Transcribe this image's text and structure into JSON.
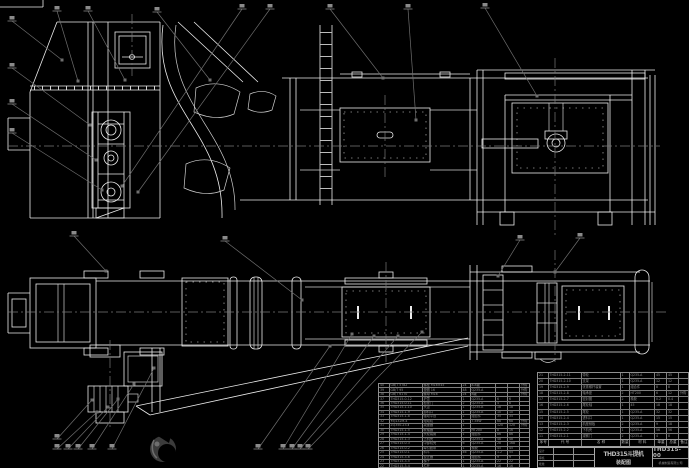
{
  "drawing": {
    "title": "THD315斗提机",
    "subtitle": "装配图",
    "drawing_no": "THD315-00",
    "company": "机械制造有限公司"
  },
  "colors": {
    "background": "#000000",
    "linework": "#ececec",
    "dim_gray": "#8a8a8a",
    "leader_gray": "#6e6e6e",
    "logo_gray": "#3b3b3b"
  },
  "title_block": {
    "signature_rows": [
      "设计",
      "审核",
      "批准"
    ]
  },
  "bom_header": [
    "序号",
    "代 号",
    "名 称",
    "数量",
    "材 料",
    "单重",
    "总重",
    "备注"
  ],
  "bom_left": {
    "rows": [
      [
        "40",
        "GB/T 5782",
        "螺栓 M16×45",
        "24",
        "8.8级",
        "",
        "",
        "外购"
      ],
      [
        "39",
        "GB/T 95",
        "垫圈 16",
        "48",
        "Q235-A",
        "",
        "",
        "外购"
      ],
      [
        "38",
        "GB/T 6170",
        "螺母 M16",
        "24",
        "8级",
        "",
        "",
        "外购"
      ],
      [
        "37",
        "THD315-0-12",
        "护罩",
        "1",
        "Q235-A",
        "6",
        "6",
        ""
      ],
      [
        "36",
        "THD315-0-11",
        "检视门",
        "2",
        "Q235-A",
        "4",
        "8",
        ""
      ],
      [
        "35",
        "THD315-1-10",
        "头罩",
        "1",
        "Q235-A",
        "18",
        "18",
        ""
      ],
      [
        "34",
        "THD315-1-9",
        "卸料口",
        "1",
        "Q235-A",
        "10",
        "10",
        ""
      ],
      [
        "33",
        "THD315-1-8",
        "驱动平台",
        "1",
        "组合件",
        "35",
        "35",
        ""
      ],
      [
        "32",
        "YEJ132M-4",
        "电动机",
        "1",
        "7.5kW",
        "68",
        "68",
        "外购"
      ],
      [
        "31",
        "ZQ350-23-Ⅱ",
        "减速器",
        "1",
        "",
        "120",
        "120",
        "外购"
      ],
      [
        "30",
        "THD315-1-5",
        "联轴器",
        "2",
        "HT200",
        "8",
        "16",
        ""
      ],
      [
        "29",
        "THD315-1-4",
        "头轮装置",
        "1",
        "组合件",
        "86",
        "86",
        ""
      ],
      [
        "28",
        "THD315-1-3",
        "上机壳",
        "1",
        "Q235-A",
        "48",
        "48",
        ""
      ],
      [
        "27",
        "THD315-0-3",
        "中部机壳",
        "6",
        "Q235-A",
        "28",
        "168",
        ""
      ],
      [
        "26",
        "THD315-0-2",
        "牵引胶带",
        "1",
        "橡胶",
        "45",
        "45",
        ""
      ],
      [
        "25",
        "THD315-0-1",
        "料斗",
        "46",
        "Q235-A",
        "1.2",
        "55",
        ""
      ],
      [
        "24",
        "THD315-3-6",
        "逆止器",
        "1",
        "组合件",
        "9",
        "9",
        ""
      ],
      [
        "23",
        "THD315-3-5",
        "梯子",
        "1",
        "Q235-A",
        "22",
        "22",
        ""
      ],
      [
        "22",
        "THD315-3-4",
        "栏杆",
        "1",
        "Q235-A",
        "16",
        "16",
        ""
      ]
    ]
  },
  "bom_right": {
    "rows": [
      [
        "21",
        "THD315-2-11",
        "带轮",
        "1",
        "Q235-A",
        "45",
        "45",
        ""
      ],
      [
        "20",
        "THD315-2-10",
        "支架",
        "1",
        "Q235-A",
        "12",
        "12",
        ""
      ],
      [
        "19",
        "THD315-2-9",
        "张紧螺杆装置",
        "1",
        "组合件",
        "8",
        "8",
        ""
      ],
      [
        "18",
        "THD315-2-8",
        "轴承座",
        "2",
        "HT200",
        "6",
        "12",
        "外购"
      ],
      [
        "17",
        "THD315-2-7",
        "密封圈",
        "2",
        "橡胶",
        "0.2",
        "0.4",
        ""
      ],
      [
        "16",
        "THD315-2-6",
        "尾轮轴",
        "1",
        "45",
        "18",
        "18",
        ""
      ],
      [
        "15",
        "THD315-2-5",
        "尾轮",
        "1",
        "Q235-A",
        "32",
        "32",
        ""
      ],
      [
        "14",
        "THD315-2-4",
        "进料口",
        "1",
        "Q235-A",
        "15",
        "15",
        ""
      ],
      [
        "13",
        "THD315-2-3",
        "机座侧板",
        "2",
        "Q235-A",
        "9",
        "18",
        ""
      ],
      [
        "12",
        "THD315-2-2",
        "下机壳",
        "1",
        "Q235-A",
        "56",
        "56",
        ""
      ],
      [
        "11",
        "THD315-2-1",
        "观察门",
        "2",
        "Q235-A",
        "4",
        "8",
        ""
      ]
    ]
  },
  "callouts": [
    [
      57,
      11,
      78,
      81
    ],
    [
      88,
      11,
      125,
      80
    ],
    [
      157,
      12,
      210,
      80
    ],
    [
      242,
      9,
      122,
      186
    ],
    [
      270,
      9,
      138,
      192
    ],
    [
      330,
      9,
      383,
      78
    ],
    [
      408,
      9,
      416,
      120
    ],
    [
      485,
      8,
      537,
      96
    ],
    [
      12,
      21,
      62,
      60
    ],
    [
      12,
      68,
      90,
      125
    ],
    [
      12,
      104,
      96,
      160
    ],
    [
      12,
      133,
      102,
      190
    ],
    [
      74,
      236,
      106,
      271
    ],
    [
      225,
      241,
      302,
      300
    ],
    [
      520,
      240,
      498,
      276
    ],
    [
      580,
      238,
      555,
      272
    ],
    [
      57,
      439,
      92,
      400
    ],
    [
      57,
      449,
      97,
      412
    ],
    [
      68,
      449,
      108,
      407
    ],
    [
      78,
      449,
      118,
      399
    ],
    [
      92,
      449,
      134,
      384
    ],
    [
      112,
      449,
      154,
      368
    ],
    [
      258,
      449,
      330,
      346
    ],
    [
      283,
      449,
      352,
      334
    ],
    [
      292,
      449,
      374,
      336
    ],
    [
      300,
      449,
      398,
      336
    ],
    [
      308,
      449,
      422,
      332
    ]
  ]
}
